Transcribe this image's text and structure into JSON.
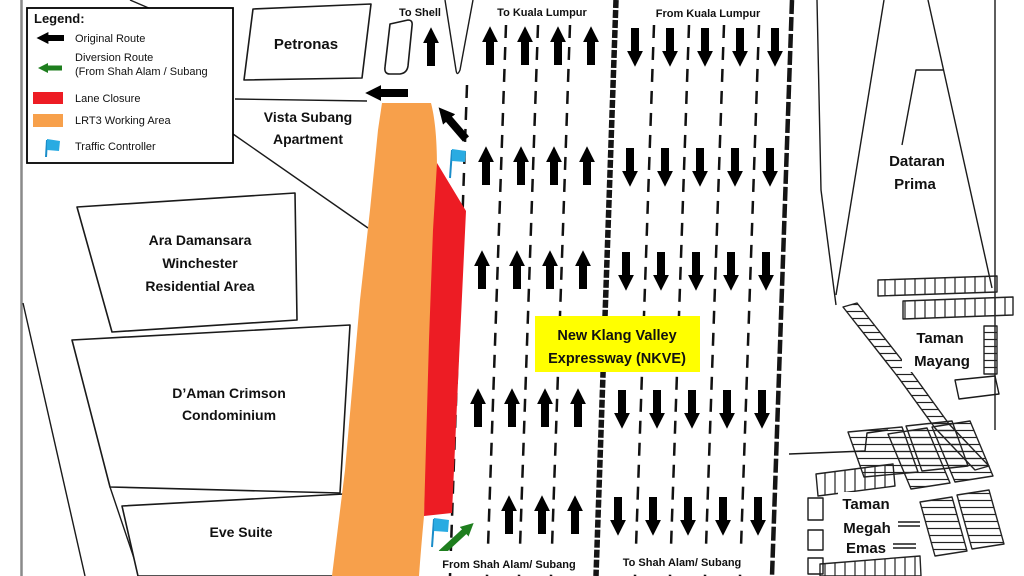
{
  "legend": {
    "title": "Legend:",
    "original_route": "Original Route",
    "diversion_route_line1": "Diversion Route",
    "diversion_route_line2": "(From Shah Alam / Subang",
    "lane_closure": "Lane Closure",
    "lrt3_working_area": "LRT3 Working Area",
    "traffic_controller": "Traffic Controller"
  },
  "roads": {
    "to_shell": "To Shell",
    "to_kuala_lumpur": "To Kuala Lumpur",
    "from_kuala_lumpur": "From Kuala Lumpur",
    "from_shah_alam_subang": "From Shah Alam/ Subang",
    "to_shah_alam_subang": "To Shah Alam/ Subang"
  },
  "expressway": {
    "line1": "New Klang Valley",
    "line2": "Expressway (NKVE)"
  },
  "places": {
    "petronas": "Petronas",
    "vista_subang_line1": "Vista Subang",
    "vista_subang_line2": "Apartment",
    "ara_line1": "Ara Damansara",
    "ara_line2": "Winchester",
    "ara_line3": "Residential Area",
    "daman_line1": "D’Aman Crimson",
    "daman_line2": "Condominium",
    "eve_suite": "Eve Suite",
    "dataran_line1": "Dataran",
    "dataran_line2": "Prima",
    "taman_mayang_line1": "Taman",
    "taman_mayang_line2": "Mayang",
    "taman_megah_line1": "Taman",
    "taman_megah_line2": "Megah",
    "taman_megah_line3": "Emas"
  },
  "colors": {
    "original_route": "#000000",
    "diversion_route": "#1e7e1e",
    "lane_closure": "#ed1c24",
    "lrt3_working_area": "#f7a04b",
    "traffic_controller": "#29abe2",
    "expressway_label_bg": "#ffff00"
  }
}
